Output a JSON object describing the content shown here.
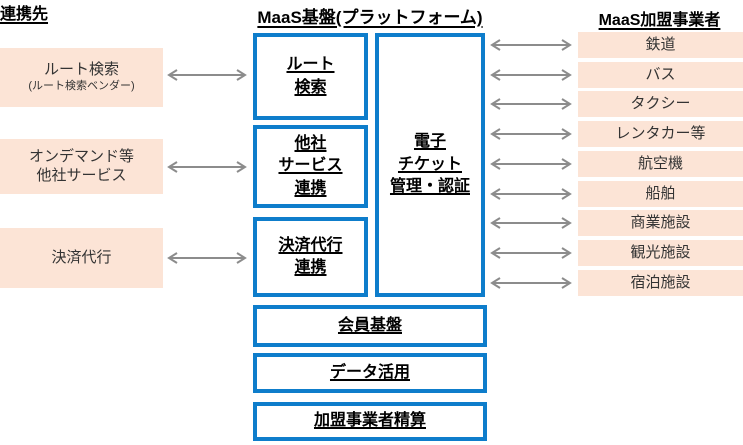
{
  "colors": {
    "pink": "#FCE4D6",
    "blue": "#0E7DCB",
    "arrow": "#8C8C8C",
    "text": "#333333"
  },
  "partners": {
    "header": "連携先",
    "items": [
      {
        "label": "ルート検索",
        "sublabel": "(ルート検索ベンダー)"
      },
      {
        "label": "オンデマンド等\n他社サービス",
        "sublabel": ""
      },
      {
        "label": "決済代行",
        "sublabel": ""
      }
    ]
  },
  "platform": {
    "header": "MaaS基盤(プラットフォーム)",
    "modules": [
      {
        "label": "ルート\n検索"
      },
      {
        "label": "他社\nサービス\n連携"
      },
      {
        "label": "決済代行\n連携"
      }
    ],
    "ticket_label": "電子\nチケット\n管理・認証",
    "foundations": [
      {
        "label": "会員基盤"
      },
      {
        "label": "データ活用"
      },
      {
        "label": "加盟事業者精算"
      }
    ]
  },
  "members": {
    "header": "MaaS加盟事業者",
    "items": [
      "鉄道",
      "バス",
      "タクシー",
      "レンタカー等",
      "航空機",
      "船舶",
      "商業施設",
      "観光施設",
      "宿泊施設"
    ]
  }
}
